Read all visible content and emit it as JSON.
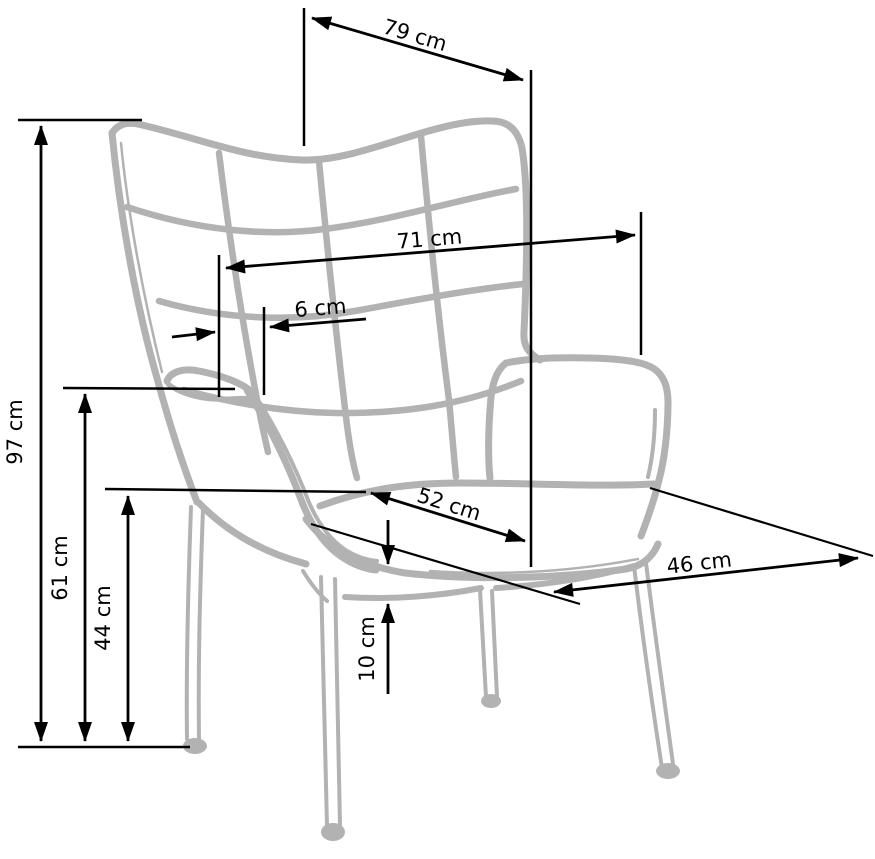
{
  "drawing": {
    "subject": "wingback armchair technical line drawing with measurements",
    "unit": "cm",
    "colors": {
      "chair_outline": "#b2b2b2",
      "dimension_lines": "#000000",
      "background": "#ffffff"
    },
    "dimensions": [
      {
        "id": "overall-width",
        "label": "79 cm",
        "value": 79
      },
      {
        "id": "backrest-width",
        "label": "71 cm",
        "value": 71
      },
      {
        "id": "wing-offset",
        "label": "6 cm",
        "value": 6
      },
      {
        "id": "overall-height",
        "label": "97 cm",
        "value": 97
      },
      {
        "id": "armrest-height",
        "label": "61 cm",
        "value": 61
      },
      {
        "id": "seat-height",
        "label": "44 cm",
        "value": 44
      },
      {
        "id": "seat-width",
        "label": "52 cm",
        "value": 52
      },
      {
        "id": "cushion-thickness",
        "label": "10 cm",
        "value": 10
      },
      {
        "id": "seat-depth",
        "label": "46 cm",
        "value": 46
      }
    ]
  }
}
